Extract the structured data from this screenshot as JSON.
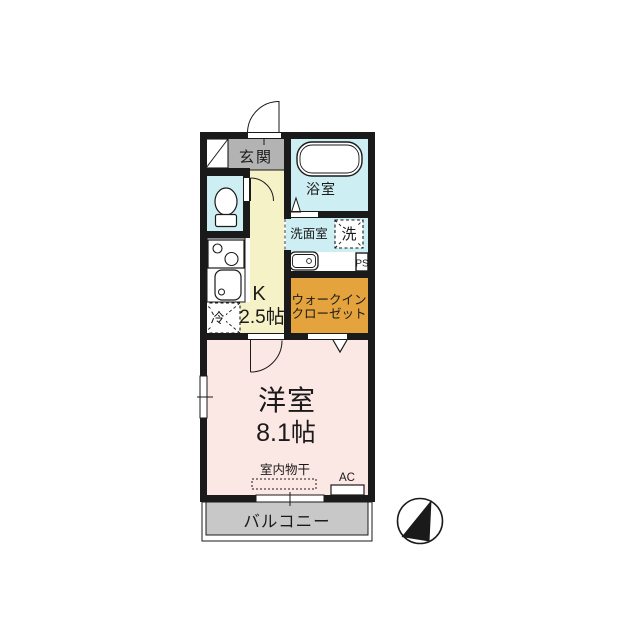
{
  "colors": {
    "wall": "#1a1a1a",
    "water_rooms": "#cdeef2",
    "kitchen": "#f6f2c8",
    "bedroom": "#fbe7e4",
    "closet": "#e4a33c",
    "entrance": "#b3b3b3",
    "balcony": "#c8c8c8"
  },
  "labels": {
    "entrance": "玄関",
    "bathroom": "浴室",
    "washroom": "洗面室",
    "washer": "洗",
    "pipe_space": "PS",
    "kitchen_k": "K",
    "kitchen_size": "2.5帖",
    "fridge": "冷",
    "closet_line1": "ウォークイン",
    "closet_line2": "クローゼット",
    "bedroom": "洋室",
    "bedroom_size": "8.1帖",
    "indoor_drying": "室内物干",
    "ac": "AC",
    "balcony": "バルコニー"
  },
  "icons": {
    "compass": "north-arrow-icon"
  }
}
